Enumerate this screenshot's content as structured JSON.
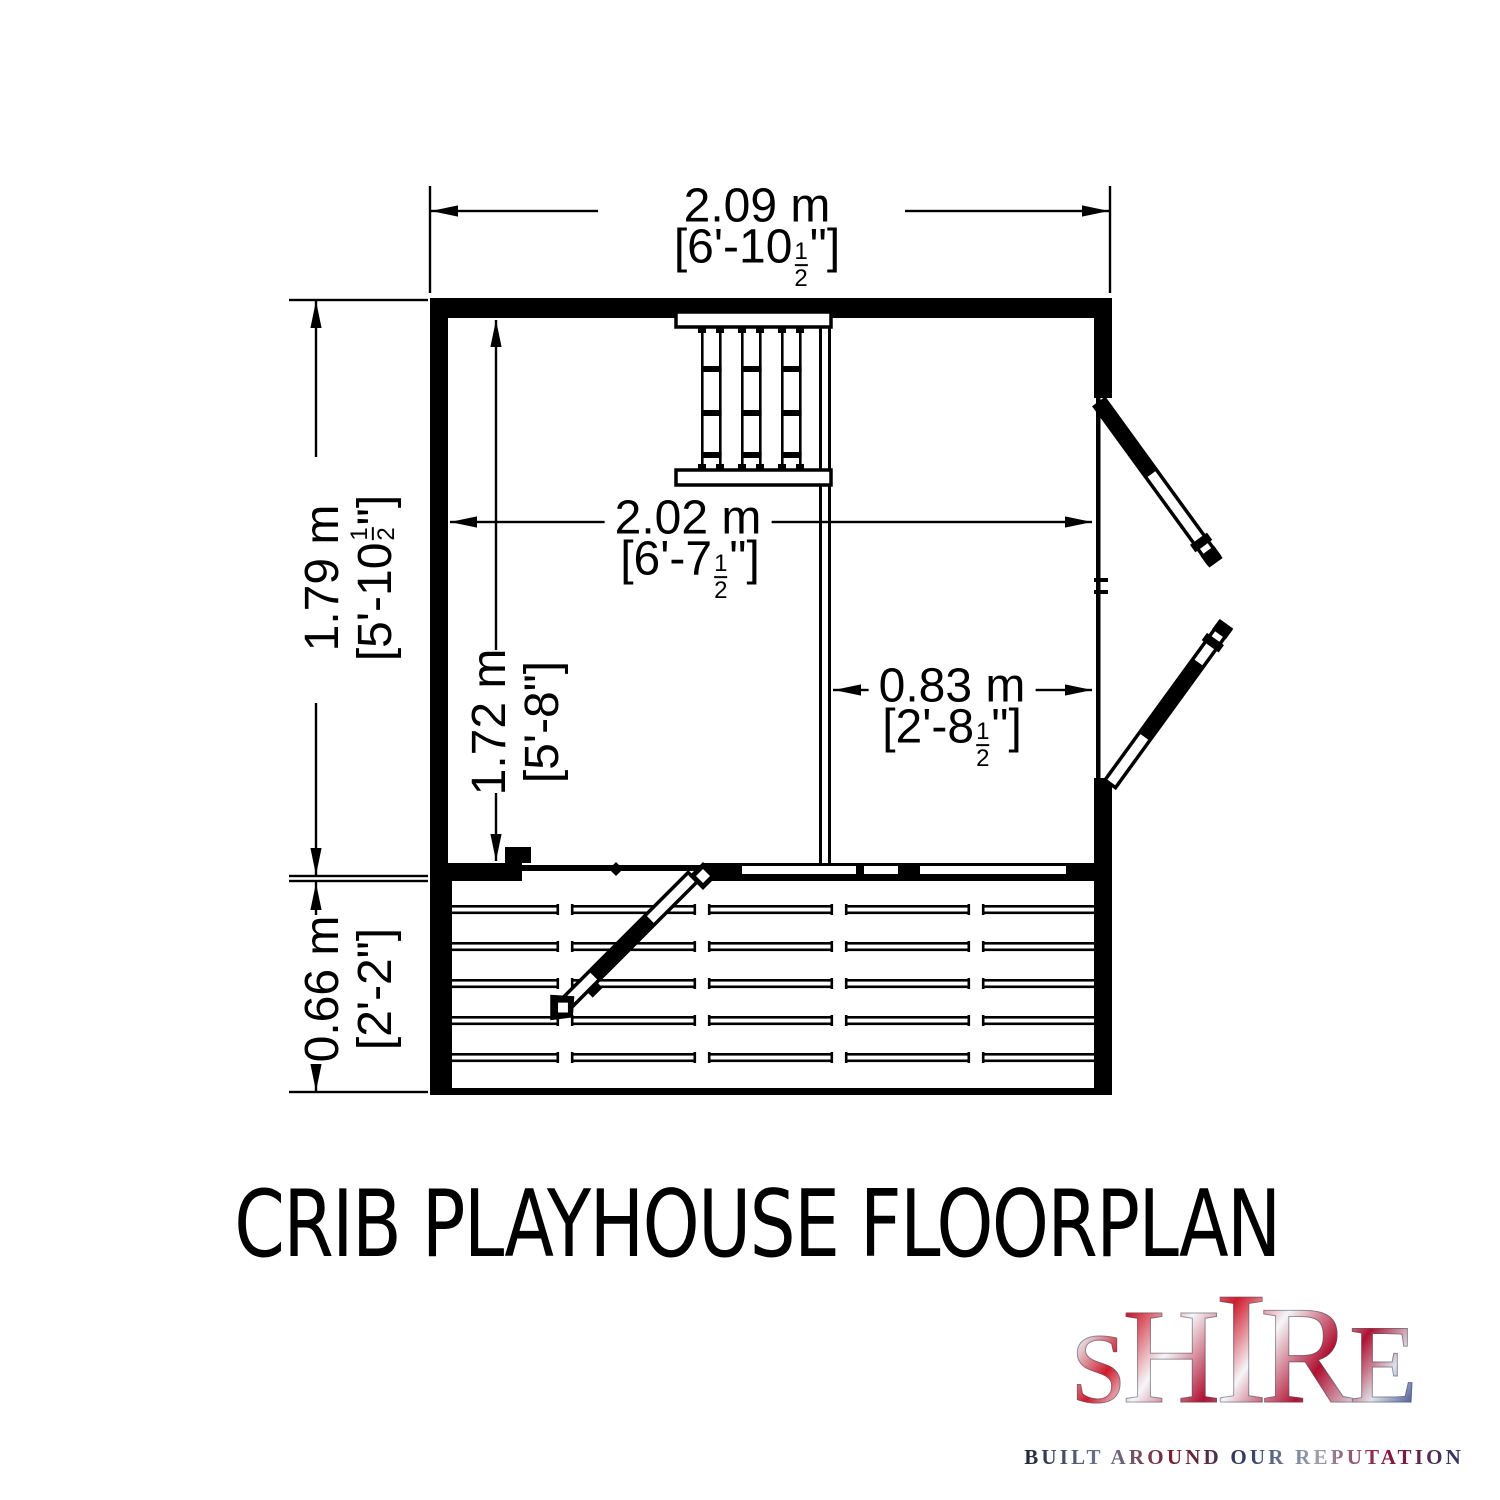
{
  "title": "CRIB PLAYHOUSE FLOORPLAN",
  "logo": {
    "word": "SHIRE",
    "letters": [
      "S",
      "H",
      "I",
      "R",
      "E"
    ],
    "tagline": "BUILT AROUND OUR REPUTATION"
  },
  "dimensions": {
    "overall_width": {
      "metric": "2.09 m",
      "imp_pre": "[6'-10",
      "frac_n": "1",
      "frac_d": "2",
      "imp_post": "\"]"
    },
    "overall_depth": {
      "metric": "1.79 m",
      "imp_pre": "[5'-10",
      "frac_n": "1",
      "frac_d": "2",
      "imp_post": "\"]"
    },
    "internal_width": {
      "metric": "2.02 m",
      "imp_pre": "[6'-7",
      "frac_n": "1",
      "frac_d": "2",
      "imp_post": "\"]"
    },
    "internal_depth": {
      "metric": "1.72 m",
      "imp": "[5'-8\"]"
    },
    "room_width": {
      "metric": "0.83 m",
      "imp_pre": "[2'-8",
      "frac_n": "1",
      "frac_d": "2",
      "imp_post": "\"]"
    },
    "deck_depth": {
      "metric": "0.66 m",
      "imp": "[2'-2\"]"
    }
  }
}
